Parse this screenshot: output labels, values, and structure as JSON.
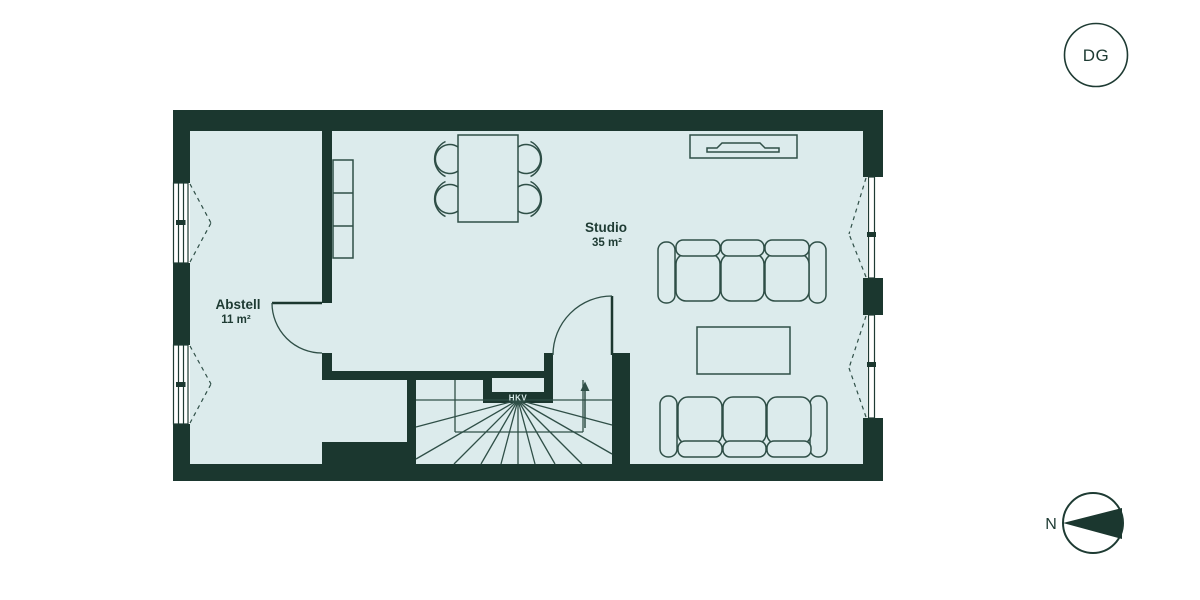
{
  "floor_badge": {
    "label": "DG"
  },
  "plan": {
    "rooms": [
      {
        "name": "Abstell",
        "area": "11 m²"
      },
      {
        "name": "Studio",
        "area": "35 m²"
      }
    ],
    "stairs": {
      "distributor_label": "HKV",
      "direction": "up"
    }
  },
  "compass": {
    "north_label": "N",
    "needle_direction": "left"
  },
  "colors": {
    "wall": "#1b372f",
    "floor": "#dcebec",
    "furniture_line": "#2f4f47",
    "label_text": "#1e3b33",
    "hkv_text": "#d7e9e8",
    "background": "#ffffff"
  }
}
